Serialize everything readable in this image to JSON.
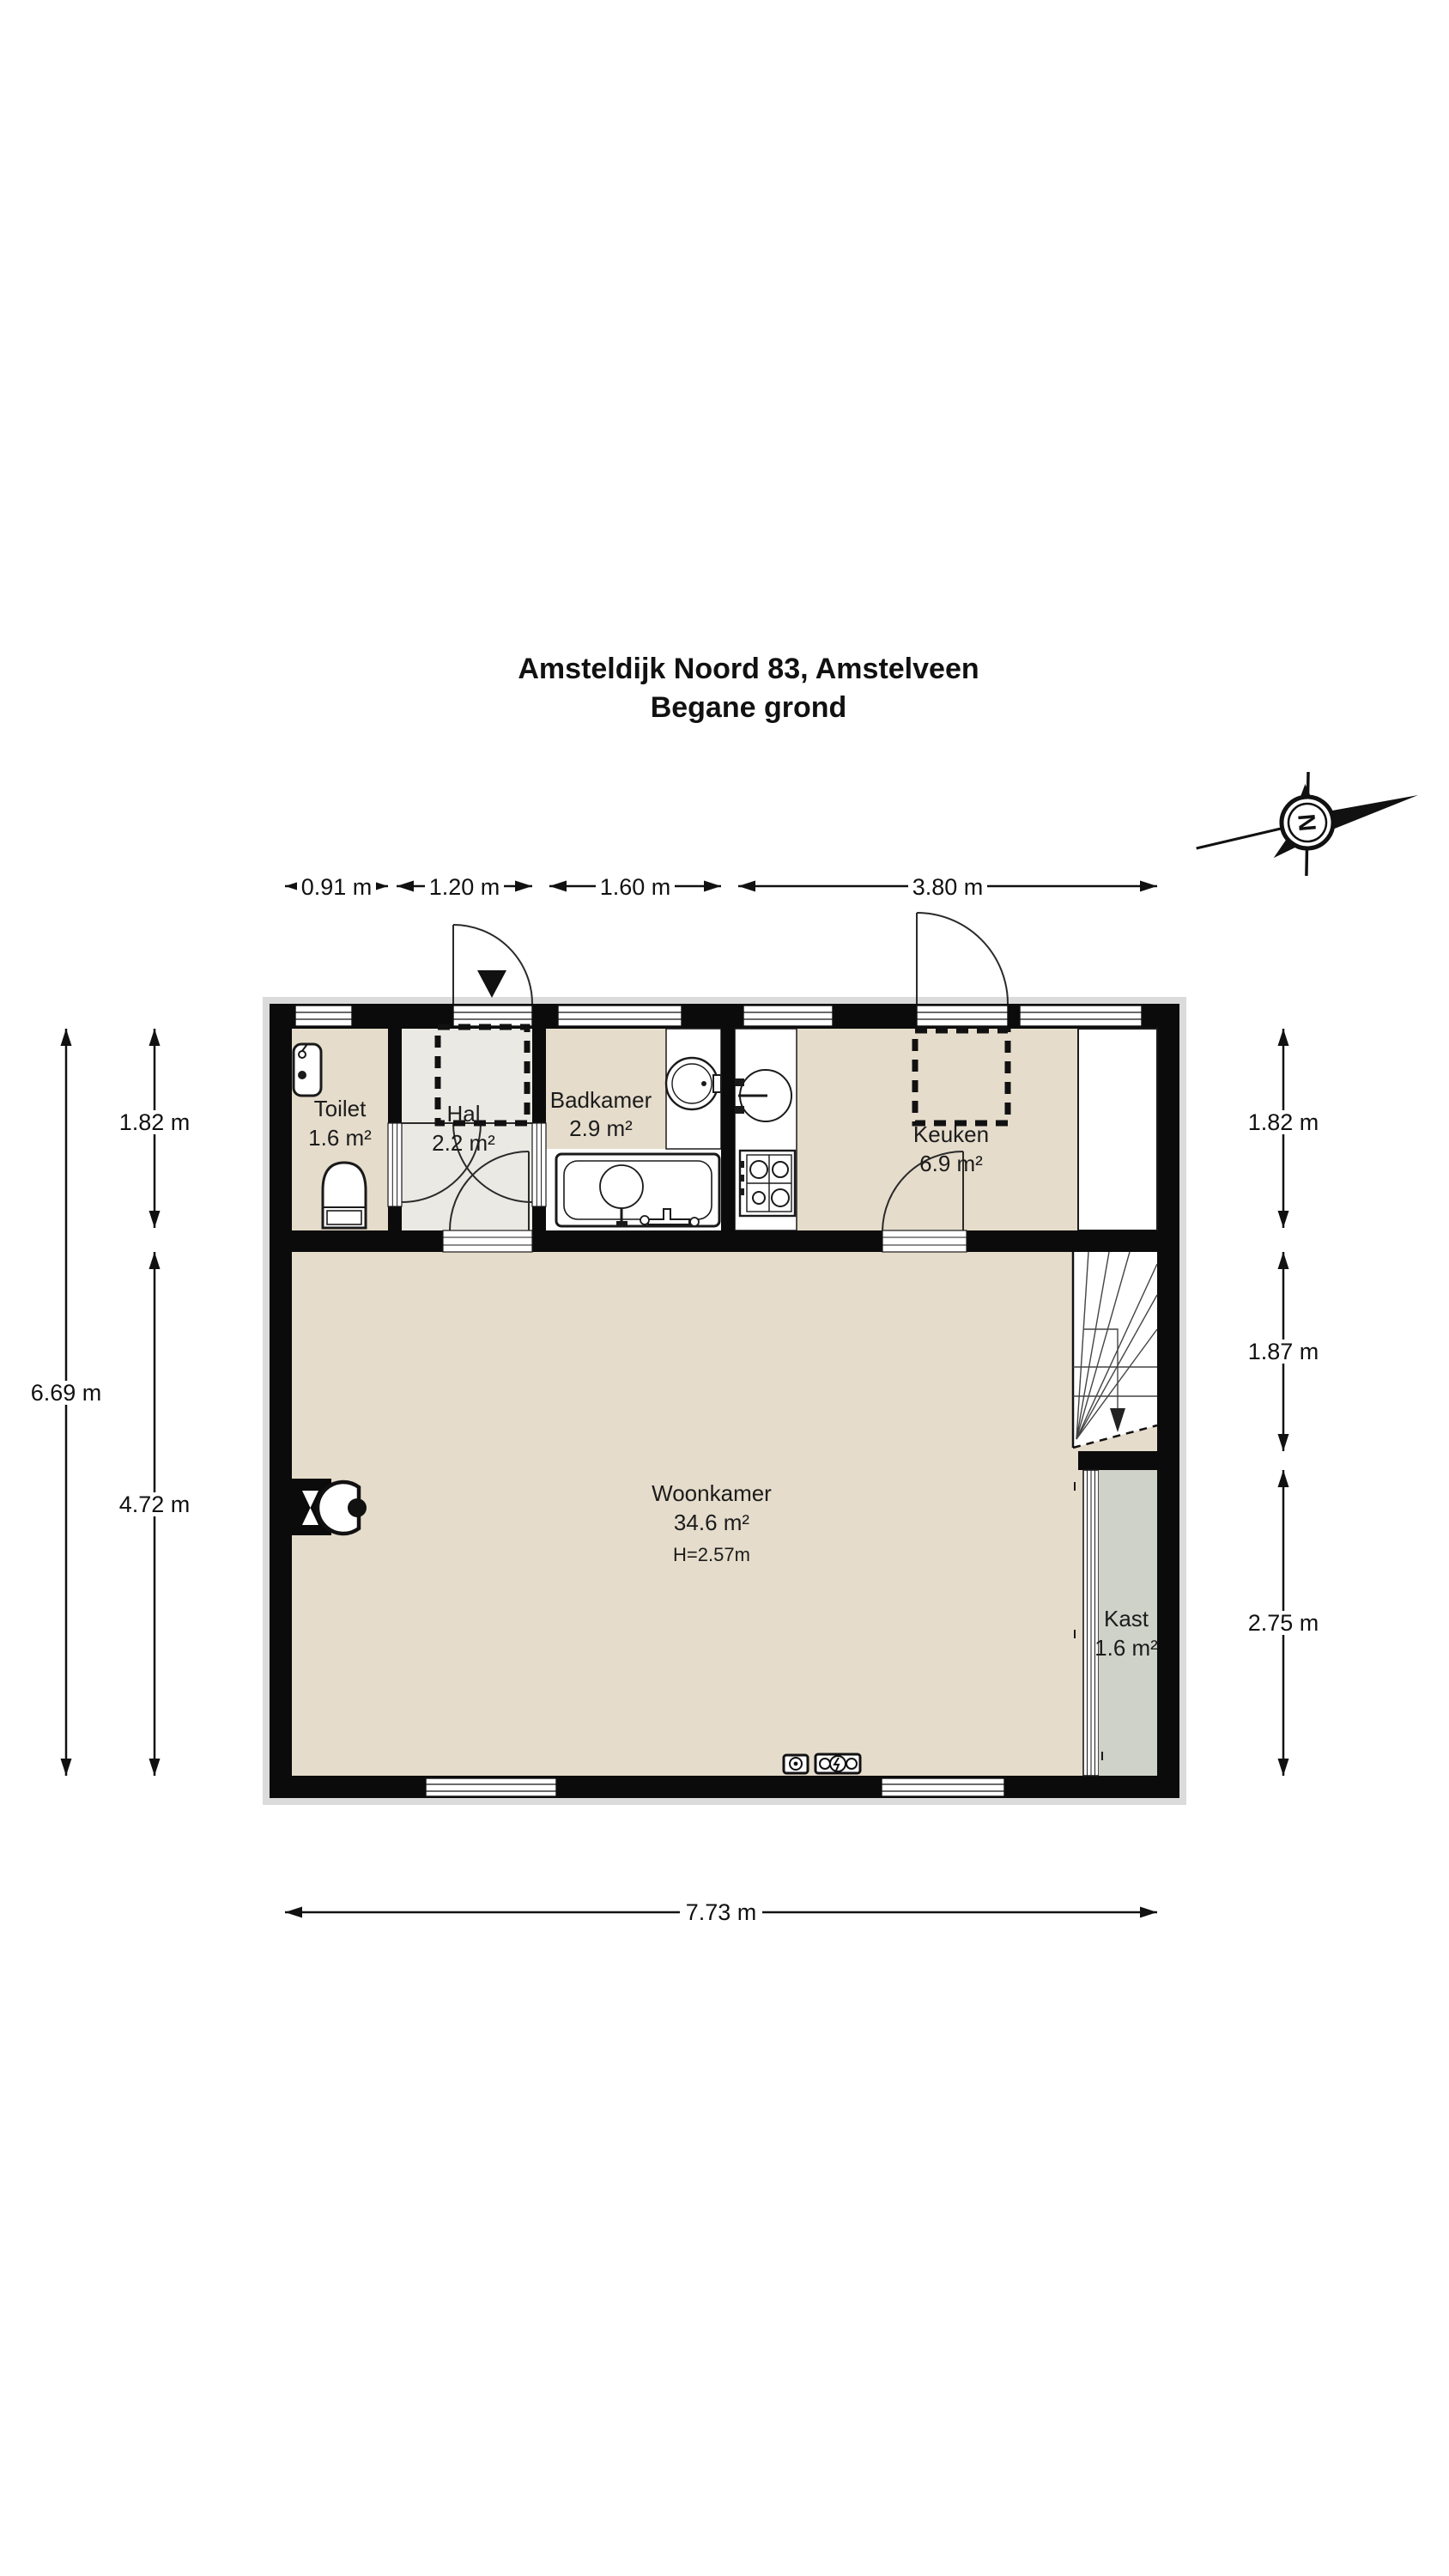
{
  "title": {
    "line1": "Amsteldijk Noord 83, Amstelveen",
    "line2": "Begane grond"
  },
  "compass": {
    "letter": "N"
  },
  "dimensions": {
    "top": [
      "0.91 m",
      "1.20 m",
      "1.60 m",
      "3.80 m"
    ],
    "left_outer": "6.69 m",
    "left_inner_top": "1.82 m",
    "left_inner_bottom": "4.72 m",
    "right_top": "1.82 m",
    "right_middle": "1.87 m",
    "right_bottom": "2.75 m",
    "bottom": "7.73 m"
  },
  "rooms": {
    "toilet": {
      "name": "Toilet",
      "area": "1.6 m²"
    },
    "hal": {
      "name": "Hal",
      "area": "2.2 m²"
    },
    "badkamer": {
      "name": "Badkamer",
      "area": "2.9 m²"
    },
    "keuken": {
      "name": "Keuken",
      "area": "6.9 m²"
    },
    "woonkamer": {
      "name": "Woonkamer",
      "area": "34.6 m²",
      "height": "H=2.57m"
    },
    "kast": {
      "name": "Kast",
      "area": "1.6 m²"
    }
  },
  "colors": {
    "floor_beige": "#e5dccb",
    "floor_hal": "#ebe9e4",
    "floor_kast": "#ced2c8",
    "wall": "#0b0b0b",
    "shadow": "#dbdbdb"
  }
}
